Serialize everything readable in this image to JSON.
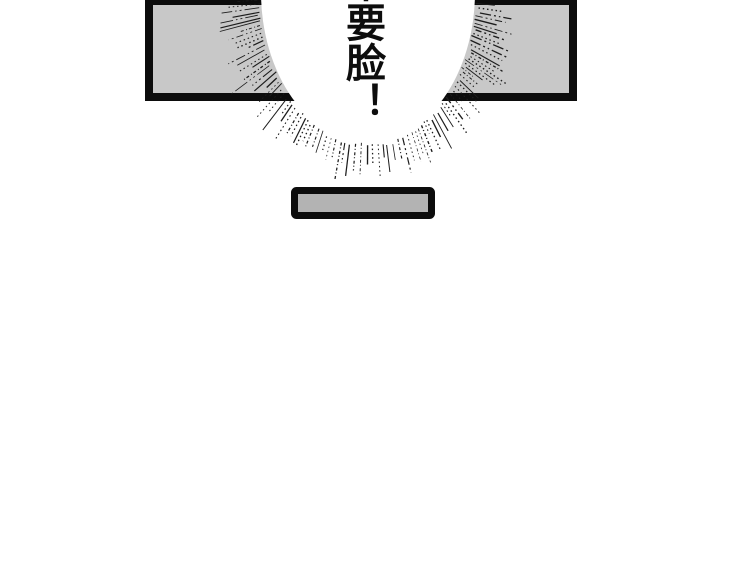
{
  "speech": {
    "text": "不要脸！"
  },
  "colors": {
    "background": "#ffffff",
    "panel_fill": "#c8c8c8",
    "panel_border": "#0c0c0c",
    "bubble_fill": "#ffffff",
    "table_fill": "#b3b3b3",
    "table_border": "#0c0c0c",
    "burst_line_color": "#1d1d1d",
    "text_color": "#0d0d0d"
  },
  "burst": {
    "center_x": 368,
    "center_y": -8,
    "radius_x": 107,
    "radius_y": 150
  }
}
